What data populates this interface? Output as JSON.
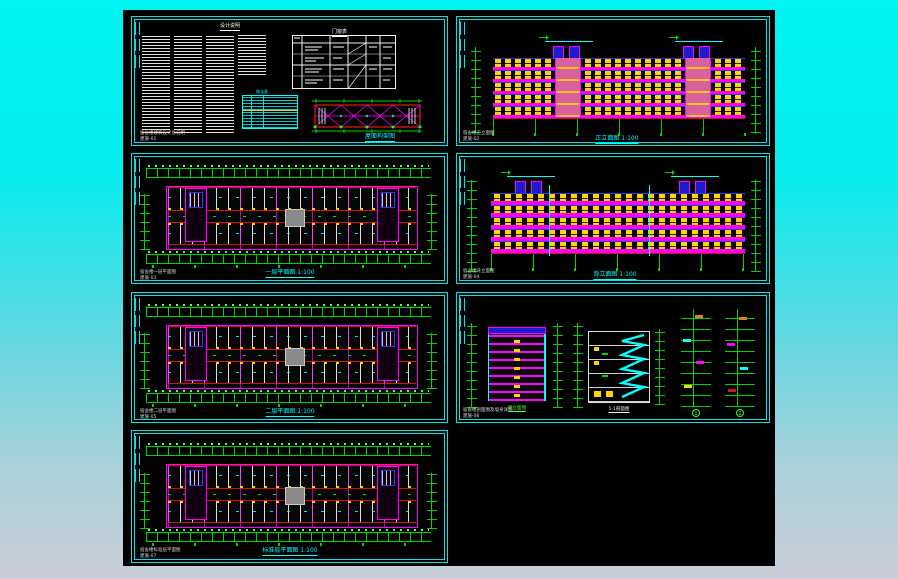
{
  "window": {
    "background_top": "#00f4f4",
    "background_bottom": "#c9cdd8",
    "canvas_color": "#000000"
  },
  "palette": {
    "frame_cyan": "#00e6e6",
    "dimension_green": "#00d400",
    "wall_red": "#cf1212",
    "accent_magenta": "#ff00ff",
    "window_yellow": "#ffd400",
    "floor_line_blue": "#2a3cf0",
    "label_cyan": "#00ffff",
    "text_white": "#e9e9e9"
  },
  "panels": {
    "notes": {
      "title": "设计说明",
      "schedule_title": "门窗表",
      "finish_table_title": "做法表",
      "truss_caption": "屋面构架图",
      "footer_line1": "宿舍楼建筑设计总说明",
      "footer_line2": "建施-01"
    },
    "front_elevation": {
      "caption": "正立面图 1:100",
      "footer_line1": "宿舍楼正立面图",
      "footer_line2": "建施-02"
    },
    "first_floor_plan": {
      "caption": "一层平面图 1:100",
      "footer_line1": "宿舍楼一层平面图",
      "footer_line2": "建施-03"
    },
    "rear_elevation": {
      "caption": "背立面图 1:100",
      "footer_line1": "宿舍楼背立面图",
      "footer_line2": "建施-04"
    },
    "second_floor_plan": {
      "caption": "二层平面图 1:100",
      "footer_line1": "宿舍楼二层平面图",
      "footer_line2": "建施-05"
    },
    "sections": {
      "caption_side": "侧立面图",
      "caption_section": "1-1剖面图",
      "caption_detail_1": "1",
      "caption_detail_2": "2",
      "footer_line1": "宿舍楼剖面图及墙身详图",
      "footer_line2": "建施-06"
    },
    "standard_floor_plan": {
      "caption": "标准层平面图 1:100",
      "footer_line1": "宿舍楼标准层平面图",
      "footer_line2": "建施-07"
    }
  }
}
